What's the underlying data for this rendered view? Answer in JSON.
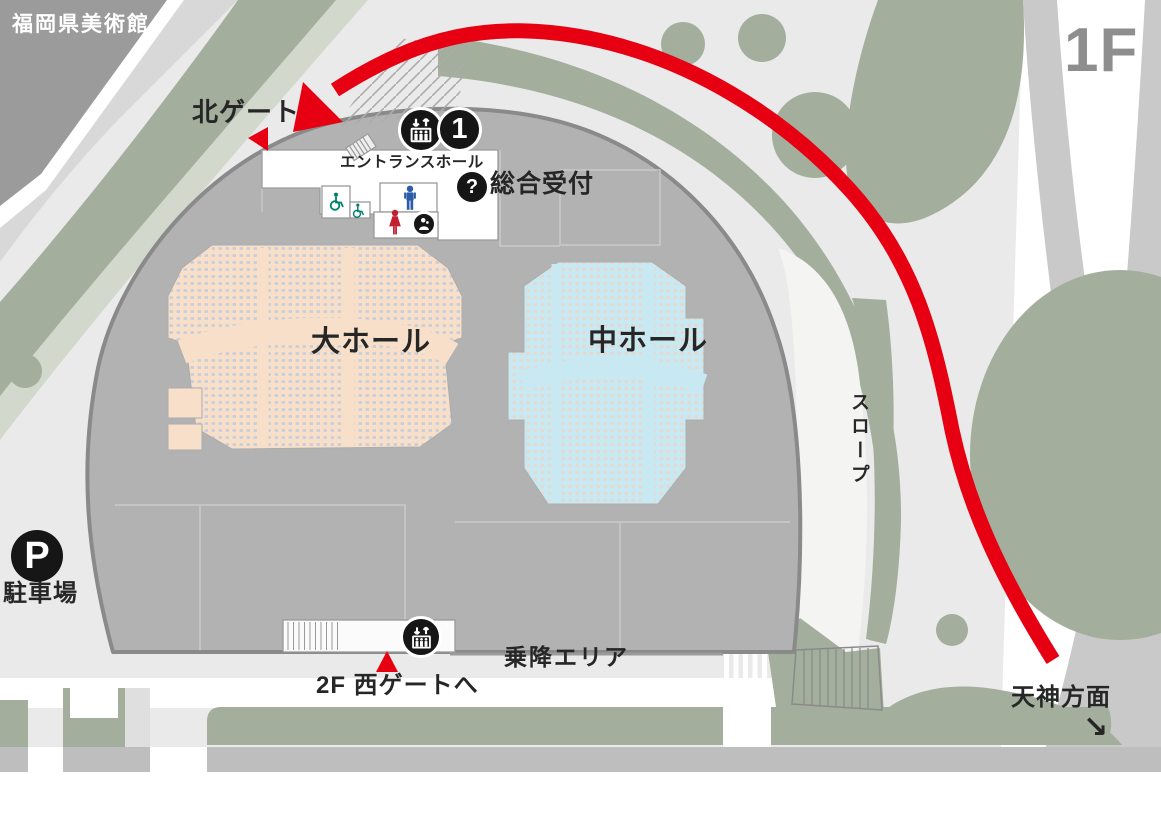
{
  "labels": {
    "museum": "福岡県美術館",
    "floor": "1F",
    "north_gate": "北ゲート",
    "entrance_hall": "エントランスホール",
    "reception": "総合受付",
    "large_hall": "大ホール",
    "medium_hall": "中ホール",
    "slope": "スロープ",
    "parking": "駐車場",
    "boarding_area": "乗降エリア",
    "west_gate": "2F 西ゲートへ",
    "tenjin": "天神方面",
    "tenjin_arrow": "↘"
  },
  "badges": {
    "elevator_number": "1",
    "reception_mark": "?",
    "parking_mark": "P"
  },
  "icons": {
    "route": "red-route-arrow",
    "gate_marker": "red-triangle-marker",
    "elevator": "elevator-icon",
    "information": "question-badge",
    "nursing_room": "nursing-room-icon",
    "accessible_toilet": "wheelchair-icon",
    "mens_toilet": "man-icon",
    "womens_toilet": "woman-icon",
    "parking": "parking-badge",
    "stairs": "stairs-hatch-icon",
    "direction": "tenjin-direction-arrow"
  },
  "colors": {
    "route_red": "#E60012",
    "plaza": "#EAEAEA",
    "greenery": "#A3AE9D",
    "greenery_pale": "#D3D8CC",
    "building_fill": "#B2B2B2",
    "building_outline": "#8A8A8A",
    "museum_fill": "#9B9B9B",
    "large_hall_fill": "#F8DFCA",
    "large_hall_seats": "#C7CEDA",
    "medium_hall_fill": "#C9E9F2",
    "medium_hall_seats": "#EAD6CC",
    "badge_black": "#161616",
    "accessible_teal": "#00806B",
    "mens_blue": "#2A5CA8",
    "womens_red": "#C21F30",
    "floor_label_gray": "#8E8E8E"
  }
}
